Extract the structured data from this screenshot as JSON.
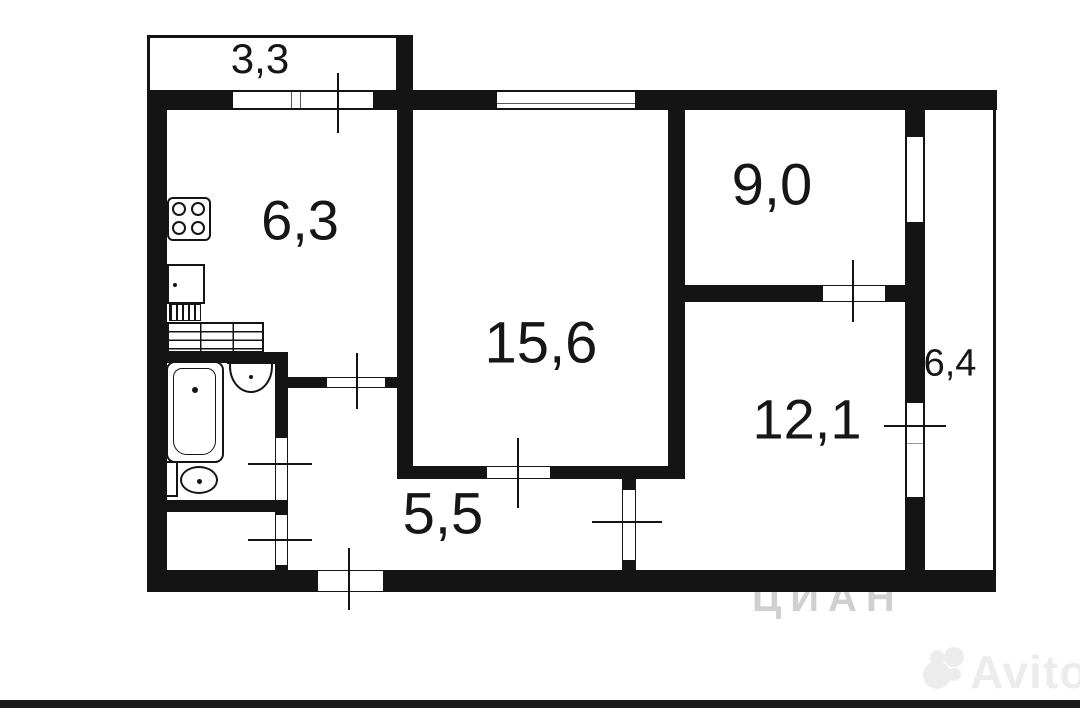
{
  "floorplan": {
    "rooms": [
      {
        "name": "balcony-top",
        "area_label": "3,3"
      },
      {
        "name": "kitchen",
        "area_label": "6,3"
      },
      {
        "name": "living-room",
        "area_label": "15,6"
      },
      {
        "name": "room-top-right",
        "area_label": "9,0"
      },
      {
        "name": "room-bottom-right",
        "area_label": "12,1"
      },
      {
        "name": "loggia-right",
        "area_label": "6,4"
      },
      {
        "name": "hallway",
        "area_label": "5,5"
      }
    ]
  },
  "watermarks": {
    "avito_text": "Avito",
    "cian_faint_text": "ЦИАН"
  }
}
